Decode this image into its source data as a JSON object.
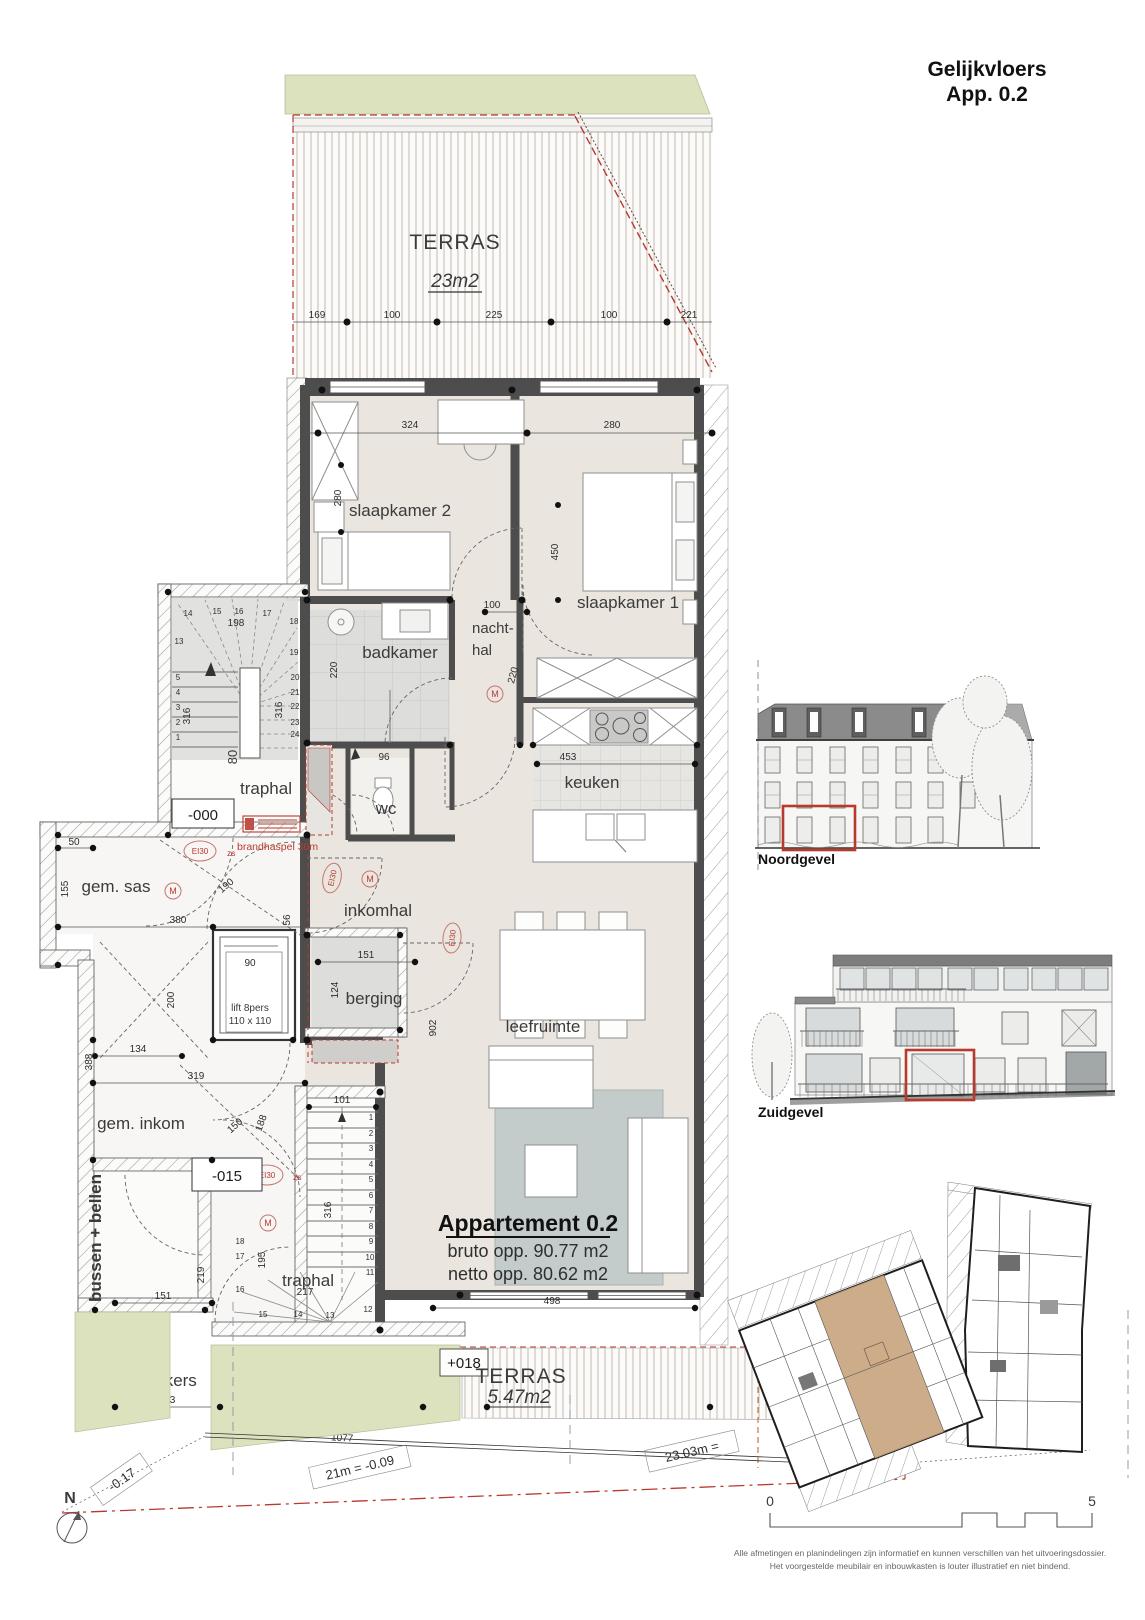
{
  "title": {
    "line1": "Gelijkvloers",
    "line2": "App. 0.2"
  },
  "apartment": {
    "name": "Appartement 0.2",
    "bruto": "bruto opp. 90.77 m2",
    "netto": "netto opp. 80.62 m2"
  },
  "rooms": {
    "terras_top": "TERRAS",
    "terras_top_area": "23m2",
    "slaapkamer2": "slaapkamer 2",
    "slaapkamer1": "slaapkamer 1",
    "badkamer": "badkamer",
    "nachthal1": "nacht-",
    "nachthal2": "hal",
    "keuken": "keuken",
    "wc": "wc",
    "traphal_top": "traphal",
    "level_000": "-000",
    "gem_sas": "gem. sas",
    "inkomhal": "inkomhal",
    "berging": "berging",
    "leefruimte": "leefruimte",
    "gem_inkom": "gem. inkom",
    "level_015": "-015",
    "traphal_bottom": "traphal",
    "bussen_bellen": "bussen + bellen",
    "klinkers": "klinkers",
    "terras_bottom": "TERRAS",
    "terras_bottom_area": "5.47m2",
    "level_018": "+018",
    "lift1": "lift 8pers",
    "lift2": "110 x 110"
  },
  "fire": {
    "brandhaspel": "brandhaspel 30m",
    "ei30": "EI30",
    "zs": "zs",
    "m": "M"
  },
  "dims": {
    "terras": [
      "169",
      "100",
      "225",
      "100",
      "221"
    ],
    "slk2_w": "324",
    "slk2_d": "280",
    "slk1_w": "280",
    "slk1_d": "450",
    "nachthal_w": "100",
    "nachthal_d": "220",
    "badkamer_d": "220",
    "keuken_w": "453",
    "trap_top_w": "198",
    "trap_top_d": "316",
    "trap_top_d2": "316",
    "trap_top_gang": "80",
    "wc_w": "96",
    "sas_50": "50",
    "sas_155": "155",
    "sas_380": "380",
    "sas_door": "190",
    "lift_90": "90",
    "lift_200": "200",
    "lift_56": "56",
    "berging_151": "151",
    "berging_124": "124",
    "leef_902": "902",
    "leef_498": "498",
    "inkom_319": "319",
    "inkom_188": "188",
    "inkom_150": "150",
    "inkom_134": "134",
    "inkom_388": "388",
    "bb_219": "219",
    "bb_151": "151",
    "trapb_101": "101",
    "trapb_316": "316",
    "trapb_195": "195",
    "trapb_217": "217",
    "klink_163": "163",
    "klink_318": "318",
    "klink_1077": "1077",
    "terrasb_443": "443"
  },
  "stairs": {
    "top": [
      "13",
      "14",
      "15",
      "16",
      "17",
      "18",
      "19",
      "20",
      "21",
      "22",
      "23",
      "24"
    ],
    "top_left": [
      "5",
      "4",
      "3",
      "2",
      "1"
    ],
    "bottom_right": [
      "1",
      "2",
      "3",
      "4",
      "5",
      "6",
      "7",
      "8",
      "9",
      "10",
      "11"
    ],
    "bottom_fan": [
      "12",
      "13",
      "14",
      "15"
    ],
    "bottom_left": [
      "16",
      "17",
      "18"
    ]
  },
  "boundary": {
    "b1": "-0.17",
    "b2": "21m = -0.09",
    "b3": "23.03m ="
  },
  "elevations": {
    "north": "Noordgevel",
    "south": "Zuidgevel"
  },
  "scalebar": {
    "start": "0",
    "end": "5"
  },
  "north_label": "N",
  "disclaimer": {
    "line1": "Alle afmetingen en planindelingen zijn informatief en kunnen verschillen van het uitvoeringsdossier.",
    "line2": "Het voorgestelde meubilair en inbouwkasten is louter illustratief en niet bindend."
  },
  "colors": {
    "accent_red": "#b8392e",
    "grass_green": "#dce2bd",
    "floor_beige": "#eae6df",
    "wall_gray": "#4d4d4d",
    "rug_gray": "#c3cccb",
    "highlight_tan": "#c8a47c"
  }
}
